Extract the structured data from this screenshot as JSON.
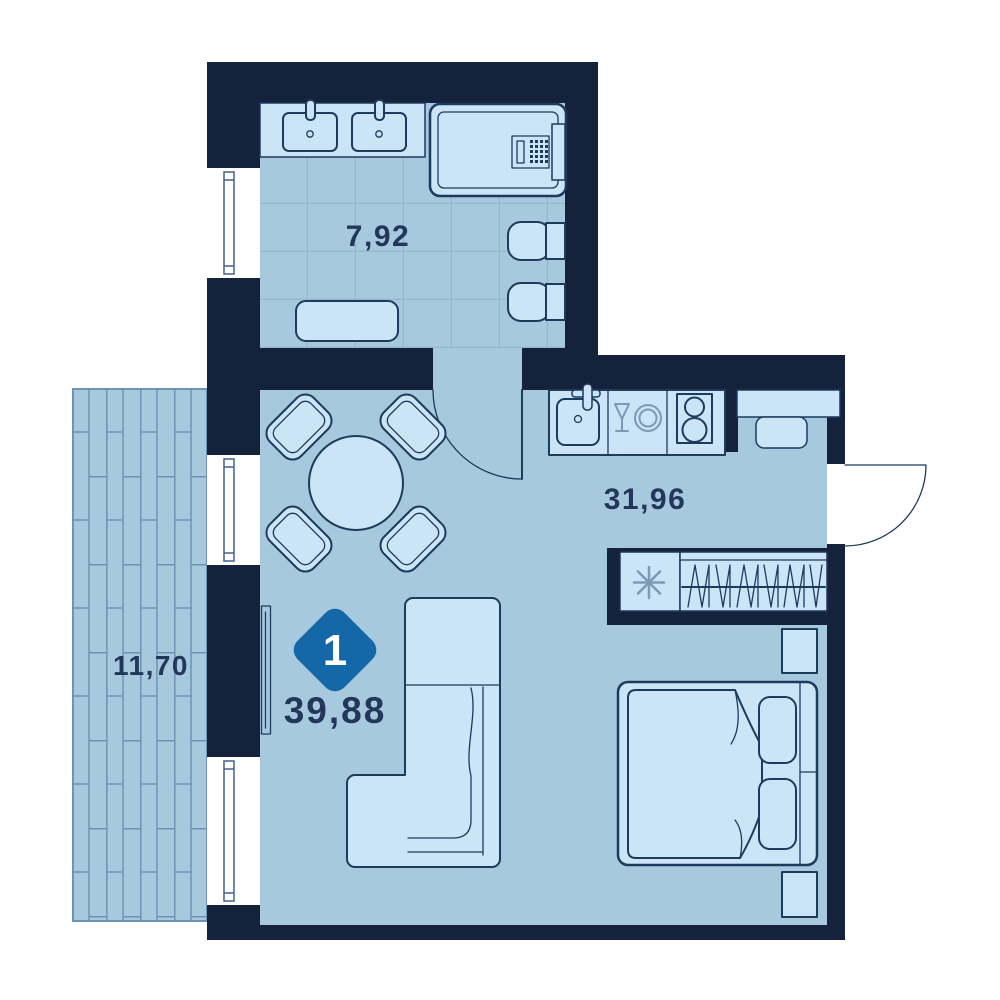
{
  "badge": {
    "rooms_count": "1",
    "total_area": "39,88"
  },
  "rooms": {
    "bathroom": {
      "area": "7,92"
    },
    "living_kitchen": {
      "area": "31,96"
    },
    "balcony": {
      "area": "11,70"
    }
  },
  "colors": {
    "wall": "#15223b",
    "floor": "#a7c9dd",
    "furniture": "#cbe4f6",
    "line": "#1d3a5f",
    "line-light": "#7d99b5",
    "tile": "#94b6cc",
    "plank": "#6e93b5",
    "badge": "#1468a8",
    "badge-text": "#ffffff",
    "text": "#23375c",
    "window-frame": "#44608c",
    "background": "#ffffff"
  }
}
